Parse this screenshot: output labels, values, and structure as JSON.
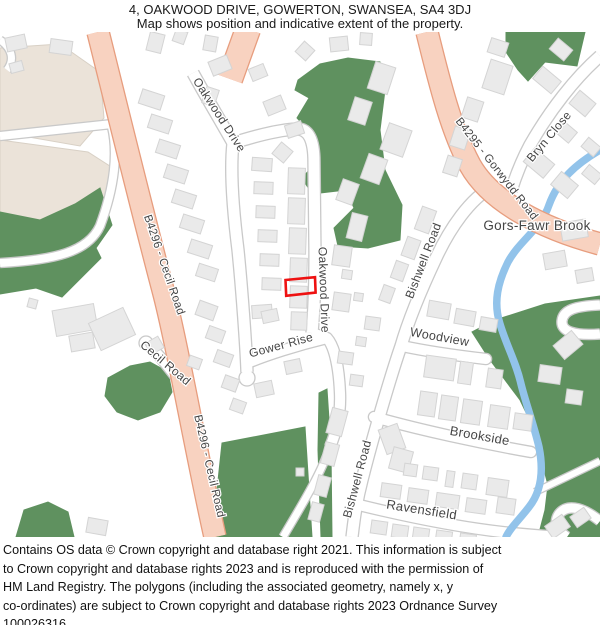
{
  "header": {
    "title": "4, OAKWOOD DRIVE, GOWERTON, SWANSEA, SA4 3DJ",
    "subtitle": "Map shows position and indicative extent of the property."
  },
  "footer": {
    "lines": [
      "Contains OS data © Crown copyright and database right 2021. This information is subject",
      "to Crown copyright and database rights 2023 and is reproduced with the permission of",
      "HM Land Registry. The polygons (including the associated geometry, namely x, y",
      "co-ordinates) are subject to Crown copyright and database rights 2023 Ordnance Survey",
      "100026316."
    ]
  },
  "map": {
    "colors": {
      "background": "#ffffff",
      "road_fill": "#ffffff",
      "road_casing": "#c9c9c9",
      "aroad_fill": "#f8d2c0",
      "aroad_casing": "#e79d7e",
      "green": "#5f915f",
      "beige": "#ebe3d9",
      "beige_stroke": "#d8d0c5",
      "building": "#eaeaea",
      "building_stroke": "#d4d4d4",
      "water": "#92c3ea",
      "label": "#454545",
      "property": "#ee1111"
    },
    "beige": [
      "0,48 60,44 100,72 104,118 80,146 0,132",
      "0,140 88,152 116,170 108,196 86,232 0,218"
    ],
    "greens": [
      "0,212 40,220 75,204 100,188 112,225 96,248 101,258 62,297 36,288 0,294",
      "108,378 130,366 150,362 168,372 172,392 160,412 138,420 117,412 105,396",
      "16,537 24,510 48,502 68,512 74,537",
      "222,443 305,427 312,537 212,537",
      "319,393 327,389 331,450 332,537 321,537 318,450",
      "298,80 320,64 348,58 380,62 385,90 380,130 385,170 402,205 400,240 368,248 338,246 334,228 354,208 346,190 312,194 302,178 320,158 315,138 297,118 309,98 295,90",
      "506,32 585,32 577,66 545,62 528,81 518,70 506,52",
      "600,296 545,304 495,320 472,332 490,360 505,380 520,400 532,425 540,455 548,485 545,510 538,537 600,537"
    ],
    "roads_white": [
      {
        "d": "M 193,73 C 205,95 220,120 233,143",
        "w": 11
      },
      {
        "d": "M 233,143 C 230,170 233,210 238,250 C 242,290 246,345 247,372",
        "w": 11
      },
      {
        "d": "M 233,143 C 252,137 278,130 296,129 C 309,128 314,141 314,162 L 315,252 C 315,287 314,312 312,333",
        "w": 11
      },
      {
        "d": "M 245,364 C 266,355 298,345 327,338",
        "w": 10
      },
      {
        "d": "M 312,333 L 327,338 C 335,347 339,369 340,393 C 341,416 336,433 330,447",
        "w": 10
      },
      {
        "d": "M 330,447 C 320,476 300,508 283,537",
        "w": 7
      },
      {
        "d": "M 188,393 C 175,375 161,357 149,345",
        "w": 10
      },
      {
        "d": "M 492,187 C 470,199 450,228 436,258 C 420,292 408,322 401,346 C 390,378 372,440 362,480 C 356,503 354,520 352,537",
        "w": 11
      },
      {
        "d": "M 402,346 C 430,352 460,356 486,359",
        "w": 10,
        "cap": "round"
      },
      {
        "d": "M 374,417 C 420,430 480,443 531,452",
        "w": 10,
        "cap": "round"
      },
      {
        "d": "M 359,505 C 400,515 450,526 502,532 C 522,534 546,536 562,537",
        "w": 10
      },
      {
        "d": "M 600,56 C 575,78 550,110 530,145 C 522,160 516,175 511,191",
        "w": 11
      },
      {
        "d": "M 600,305 C 575,306 563,310 562,321 C 561,331 573,336 600,334",
        "w": 9
      },
      {
        "d": "M 535,492 L 600,461",
        "w": 6
      },
      {
        "d": "M 600,521 C 580,505 566,505 559,514 C 553,523 558,531 567,537",
        "w": 9
      },
      {
        "d": "M 112,127 C 118,152 115,186 100,226 C 88,252 55,260 0,263",
        "w": 8
      },
      {
        "d": "M 0,136 L 112,124",
        "w": 8
      },
      {
        "d": "M 0,40 C 12,48 15,60 7,70",
        "w": 7
      }
    ],
    "culdesacs": [
      {
        "cx": 247,
        "cy": 378,
        "r": 8
      },
      {
        "cx": 146,
        "cy": 343,
        "r": 7
      }
    ],
    "roads_salmon": [
      {
        "d": "M 98,32 C 115,100 138,195 163,290 C 177,343 196,452 215,537",
        "w": 21
      },
      {
        "d": "M 248,29 L 230,79",
        "w": 24
      },
      {
        "d": "M 427,32 C 440,85 452,132 470,165 C 490,201 540,228 600,244",
        "w": 21
      }
    ],
    "brook": {
      "d": "M 600,150 C 576,164 558,180 549,205 C 541,229 520,240 508,262 C 498,282 493,302 500,324 C 507,347 516,362 521,384 C 526,404 533,422 539,447 C 544,472 541,492 529,507 C 519,520 510,528 506,537",
      "w": 7.5
    },
    "buildings": [
      [
        6,
        36,
        20,
        14,
        -12
      ],
      [
        50,
        40,
        22,
        14,
        8
      ],
      [
        148,
        33,
        15,
        19,
        14
      ],
      [
        174,
        30,
        12,
        13,
        20
      ],
      [
        204,
        36,
        13,
        15,
        10
      ],
      [
        298,
        44,
        14,
        14,
        42
      ],
      [
        330,
        37,
        18,
        14,
        -6
      ],
      [
        360,
        33,
        12,
        12,
        4
      ],
      [
        10,
        62,
        13,
        10,
        -15
      ],
      [
        210,
        58,
        20,
        15,
        -22
      ],
      [
        250,
        66,
        16,
        13,
        -22
      ],
      [
        265,
        98,
        19,
        15,
        -22
      ],
      [
        286,
        123,
        17,
        13,
        -18
      ],
      [
        204,
        88,
        13,
        17,
        18
      ],
      [
        140,
        92,
        23,
        15,
        18
      ],
      [
        149,
        117,
        22,
        14,
        18
      ],
      [
        157,
        142,
        22,
        14,
        18
      ],
      [
        165,
        167,
        22,
        14,
        18
      ],
      [
        173,
        192,
        22,
        14,
        18
      ],
      [
        181,
        217,
        22,
        14,
        18
      ],
      [
        189,
        242,
        22,
        14,
        18
      ],
      [
        197,
        266,
        20,
        13,
        18
      ],
      [
        252,
        158,
        20,
        13,
        4
      ],
      [
        254,
        182,
        19,
        12,
        2
      ],
      [
        256,
        206,
        19,
        12,
        2
      ],
      [
        258,
        230,
        19,
        12,
        2
      ],
      [
        260,
        254,
        19,
        12,
        2
      ],
      [
        262,
        278,
        19,
        12,
        2
      ],
      [
        252,
        305,
        20,
        13,
        -4
      ],
      [
        288,
        168,
        17,
        26,
        2
      ],
      [
        288,
        198,
        17,
        26,
        2
      ],
      [
        289,
        228,
        17,
        26,
        2
      ],
      [
        290,
        258,
        17,
        24,
        2
      ],
      [
        290,
        286,
        17,
        22,
        2
      ],
      [
        291,
        312,
        16,
        18,
        2
      ],
      [
        275,
        145,
        15,
        15,
        40
      ],
      [
        333,
        246,
        18,
        20,
        8
      ],
      [
        342,
        270,
        10,
        9,
        8
      ],
      [
        333,
        293,
        17,
        18,
        8
      ],
      [
        354,
        293,
        9,
        8,
        8
      ],
      [
        365,
        317,
        15,
        13,
        8
      ],
      [
        356,
        337,
        10,
        9,
        8
      ],
      [
        349,
        214,
        16,
        26,
        14
      ],
      [
        418,
        208,
        15,
        24,
        20
      ],
      [
        404,
        238,
        14,
        20,
        20
      ],
      [
        393,
        262,
        13,
        18,
        20
      ],
      [
        381,
        286,
        12,
        16,
        20
      ],
      [
        384,
        126,
        24,
        28,
        20
      ],
      [
        364,
        156,
        20,
        26,
        20
      ],
      [
        339,
        181,
        17,
        22,
        20
      ],
      [
        371,
        64,
        21,
        28,
        18
      ],
      [
        351,
        99,
        18,
        24,
        18
      ],
      [
        489,
        40,
        18,
        15,
        18
      ],
      [
        486,
        62,
        23,
        30,
        18
      ],
      [
        464,
        99,
        17,
        21,
        18
      ],
      [
        452,
        128,
        16,
        20,
        18
      ],
      [
        445,
        157,
        15,
        18,
        18
      ],
      [
        539,
        68,
        16,
        24,
        -50
      ],
      [
        554,
        40,
        14,
        19,
        -50
      ],
      [
        574,
        93,
        17,
        21,
        -50
      ],
      [
        559,
        123,
        14,
        18,
        -50
      ],
      [
        585,
        139,
        12,
        16,
        -50
      ],
      [
        530,
        150,
        18,
        26,
        -50
      ],
      [
        556,
        174,
        17,
        22,
        -50
      ],
      [
        586,
        166,
        12,
        17,
        -50
      ],
      [
        561,
        221,
        26,
        18,
        -10
      ],
      [
        544,
        252,
        22,
        16,
        -10
      ],
      [
        576,
        269,
        17,
        13,
        -10
      ],
      [
        556,
        336,
        24,
        18,
        -40
      ],
      [
        428,
        302,
        22,
        16,
        10
      ],
      [
        455,
        310,
        20,
        15,
        10
      ],
      [
        480,
        318,
        17,
        13,
        10
      ],
      [
        425,
        357,
        30,
        22,
        8
      ],
      [
        459,
        362,
        13,
        22,
        8
      ],
      [
        487,
        369,
        15,
        19,
        8
      ],
      [
        419,
        392,
        17,
        24,
        8
      ],
      [
        440,
        396,
        17,
        24,
        8
      ],
      [
        462,
        400,
        19,
        24,
        8
      ],
      [
        489,
        406,
        20,
        22,
        8
      ],
      [
        514,
        414,
        18,
        16,
        8
      ],
      [
        539,
        366,
        22,
        17,
        8
      ],
      [
        566,
        390,
        16,
        14,
        8
      ],
      [
        382,
        426,
        20,
        26,
        -20
      ],
      [
        391,
        449,
        20,
        22,
        15
      ],
      [
        404,
        464,
        13,
        12,
        8
      ],
      [
        423,
        467,
        15,
        13,
        8
      ],
      [
        446,
        471,
        8,
        16,
        8
      ],
      [
        462,
        474,
        15,
        15,
        8
      ],
      [
        487,
        479,
        21,
        17,
        8
      ],
      [
        497,
        498,
        18,
        16,
        8
      ],
      [
        381,
        484,
        20,
        14,
        8
      ],
      [
        408,
        489,
        20,
        14,
        8
      ],
      [
        436,
        494,
        23,
        14,
        8
      ],
      [
        466,
        499,
        20,
        14,
        8
      ],
      [
        371,
        521,
        16,
        13,
        8
      ],
      [
        392,
        525,
        16,
        13,
        8
      ],
      [
        413,
        528,
        16,
        12,
        8
      ],
      [
        436,
        531,
        16,
        10,
        8
      ],
      [
        460,
        534,
        16,
        8,
        8
      ],
      [
        329,
        409,
        16,
        26,
        15
      ],
      [
        323,
        443,
        14,
        22,
        15
      ],
      [
        316,
        476,
        13,
        20,
        15
      ],
      [
        310,
        503,
        12,
        18,
        15
      ],
      [
        296,
        468,
        8,
        8,
        0
      ],
      [
        54,
        307,
        42,
        26,
        -10
      ],
      [
        93,
        314,
        38,
        30,
        -25
      ],
      [
        70,
        334,
        24,
        16,
        -10
      ],
      [
        147,
        339,
        15,
        13,
        -30
      ],
      [
        28,
        299,
        9,
        9,
        15
      ],
      [
        87,
        519,
        20,
        15,
        10
      ],
      [
        547,
        519,
        21,
        15,
        -35
      ],
      [
        572,
        511,
        17,
        13,
        -35
      ],
      [
        197,
        303,
        19,
        15,
        20
      ],
      [
        207,
        328,
        17,
        13,
        20
      ],
      [
        215,
        352,
        17,
        13,
        20
      ],
      [
        223,
        377,
        15,
        13,
        20
      ],
      [
        188,
        357,
        13,
        11,
        20
      ],
      [
        231,
        400,
        14,
        12,
        20
      ],
      [
        255,
        382,
        18,
        14,
        -12
      ],
      [
        285,
        360,
        16,
        13,
        -12
      ],
      [
        338,
        352,
        15,
        12,
        8
      ],
      [
        350,
        375,
        13,
        11,
        8
      ],
      [
        262,
        310,
        16,
        12,
        -12
      ]
    ],
    "labels": [
      {
        "id": "oakwood-drive-upper",
        "text": "Oakwood Drive",
        "x": 216,
        "y": 117,
        "rot": 57,
        "size": 12
      },
      {
        "id": "oakwood-drive-lower",
        "text": "Oakwood Drive",
        "x": 320,
        "y": 290,
        "rot": 88,
        "size": 12
      },
      {
        "id": "gower-rise",
        "text": "Gower Rise",
        "x": 282,
        "y": 349,
        "rot": -15,
        "size": 12
      },
      {
        "id": "b4296-cecil-road-upper",
        "text": "B4296 - Cecil Road",
        "x": 161,
        "y": 266,
        "rot": 71,
        "size": 11.5
      },
      {
        "id": "b4296-cecil-road-lower",
        "text": "B4296 - Cecil Road",
        "x": 206,
        "y": 467,
        "rot": 77,
        "size": 11.5
      },
      {
        "id": "b4295-gorwydd-road",
        "text": "B4295 - Gorwydd Road",
        "x": 494,
        "y": 171,
        "rot": 52,
        "size": 11.5
      },
      {
        "id": "bryn-close",
        "text": "Bryn Close",
        "x": 552,
        "y": 139,
        "rot": -50,
        "size": 12
      },
      {
        "id": "gors-fawr-brook",
        "text": "Gors-Fawr Brook",
        "x": 537,
        "y": 230,
        "rot": 0,
        "size": 13.5
      },
      {
        "id": "bishwell-road-upper",
        "text": "Bishwell Road",
        "x": 427,
        "y": 262,
        "rot": -69,
        "size": 12
      },
      {
        "id": "bishwell-road-lower",
        "text": "Bishwell Road",
        "x": 361,
        "y": 480,
        "rot": -75,
        "size": 12
      },
      {
        "id": "woodview",
        "text": "Woodview",
        "x": 439,
        "y": 341,
        "rot": 10,
        "size": 12.5
      },
      {
        "id": "brookside",
        "text": "Brookside",
        "x": 479,
        "y": 440,
        "rot": 10,
        "size": 13
      },
      {
        "id": "ravensfield",
        "text": "Ravensfield",
        "x": 421,
        "y": 514,
        "rot": 9,
        "size": 13
      },
      {
        "id": "cecil-road",
        "text": "Cecil Road",
        "x": 163,
        "y": 366,
        "rot": 40,
        "size": 12
      }
    ],
    "property": {
      "points": "285.5,280 315,277.2 315.6,292.6 286.2,295.8"
    }
  }
}
